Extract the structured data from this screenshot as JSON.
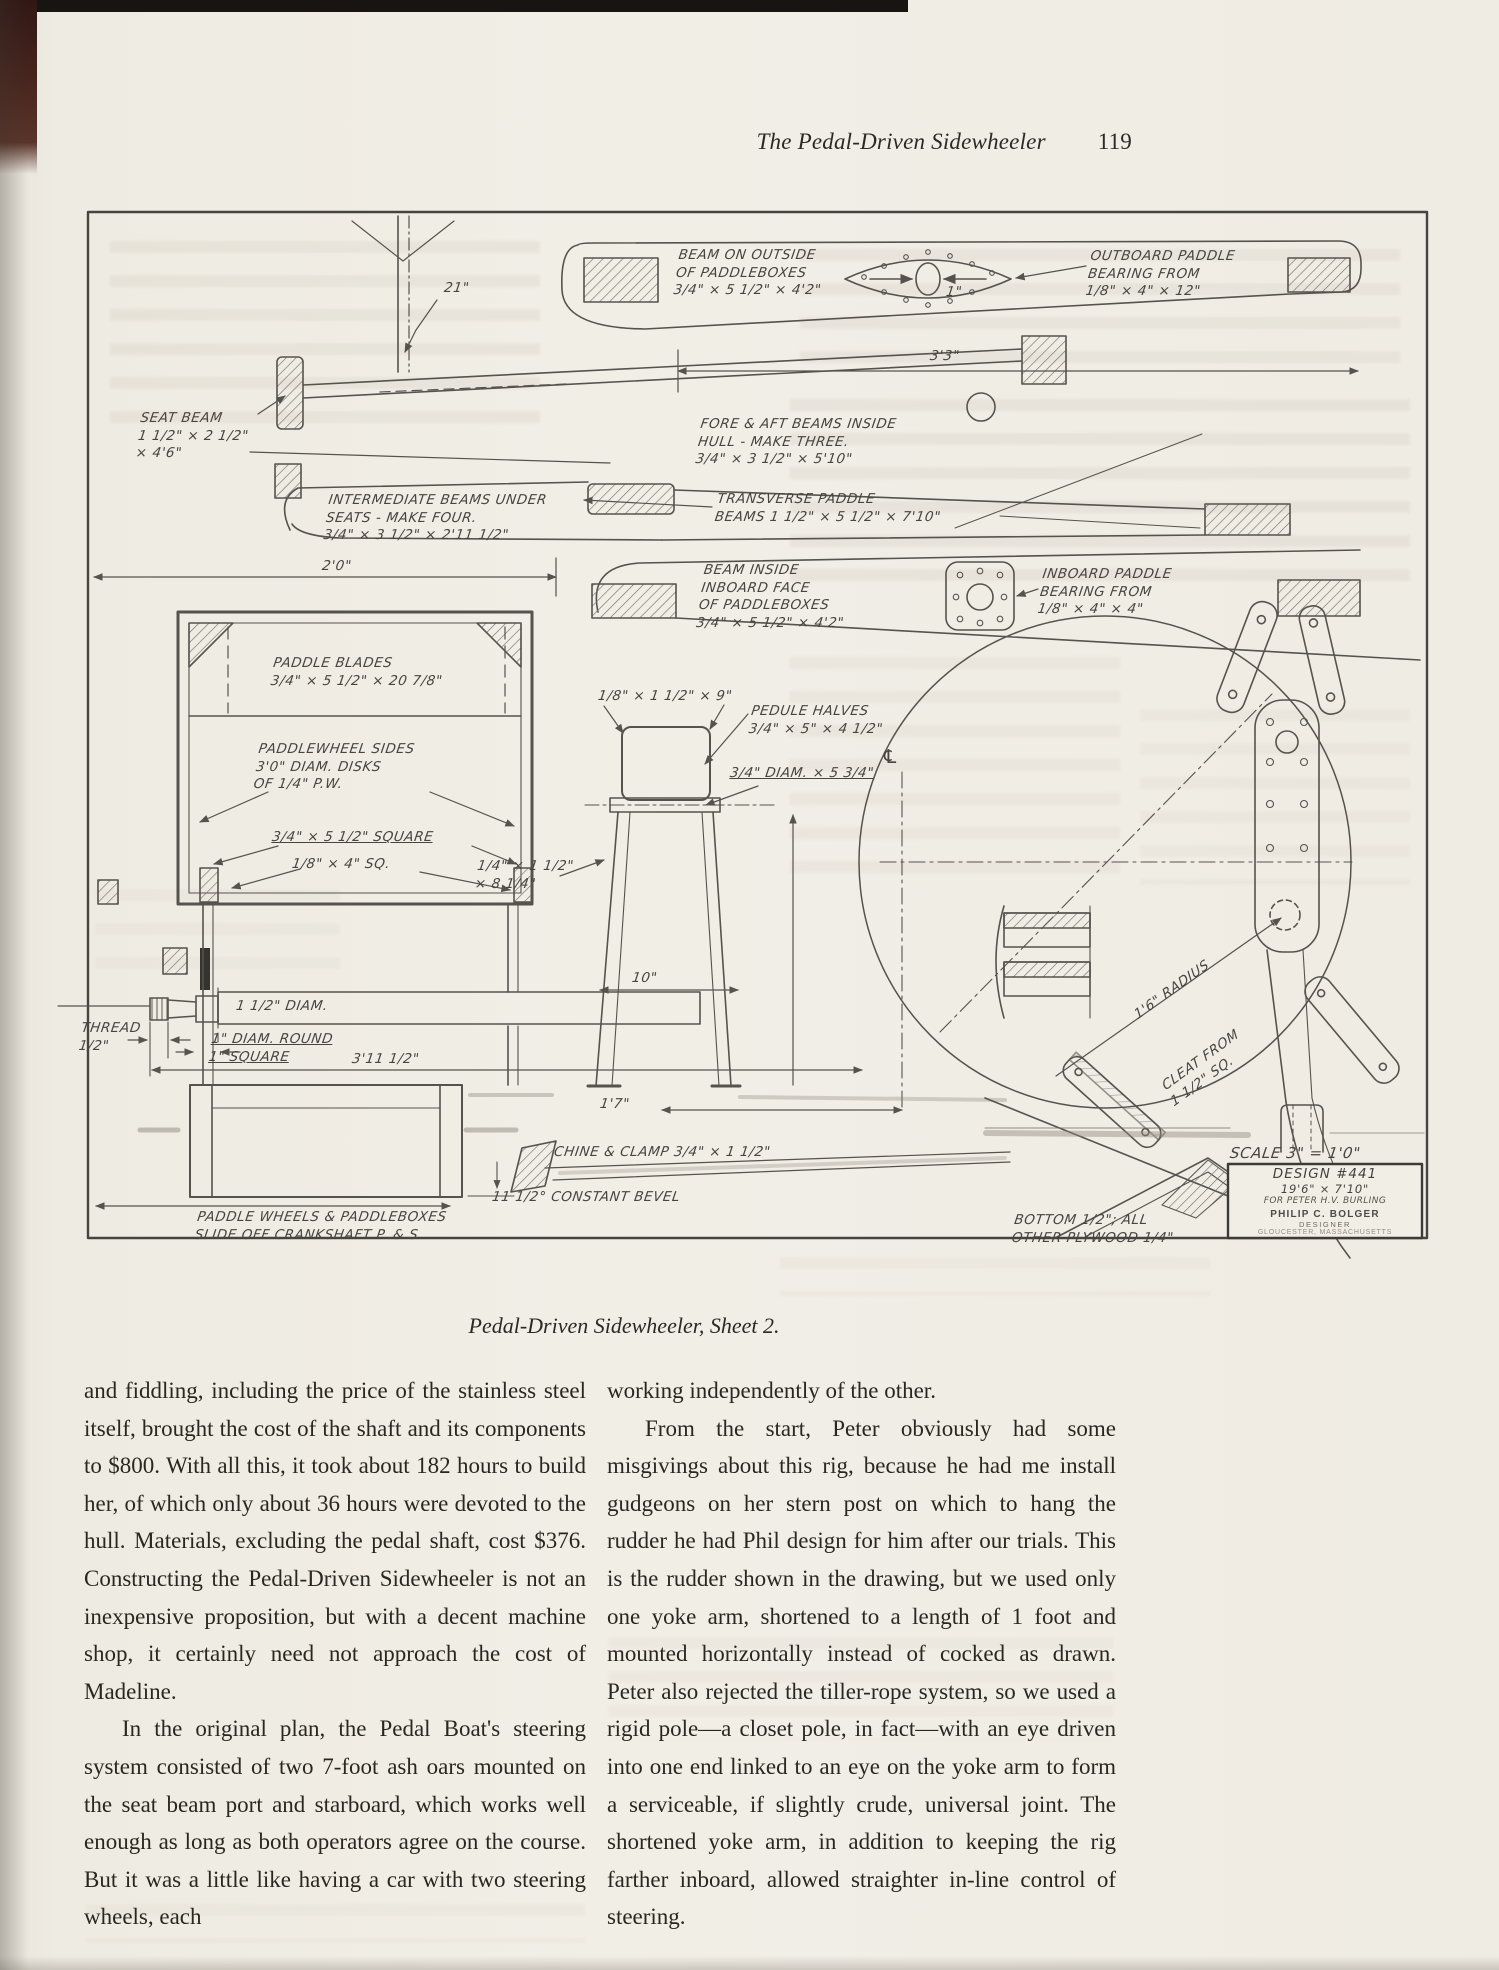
{
  "page": {
    "header": {
      "title": "The Pedal-Driven Sidewheeler",
      "page_number": "119"
    },
    "caption": "Pedal-Driven Sidewheeler, Sheet 2."
  },
  "diagram": {
    "labels": {
      "beam_outside": "BEAM ON OUTSIDE\nOF PADDLEBOXES\n3/4\" × 5 1/2\" × 4'2\"",
      "outboard_bearing": "OUTBOARD PADDLE\nBEARING FROM\n1/8\" × 4\" × 12\"",
      "dim_1in": "1\"",
      "dim_21in": "21\"",
      "dim_3ft3": "3'3\"",
      "seat_beam": "SEAT BEAM\n1 1/2\" × 2 1/2\"\n× 4'6\"",
      "fore_aft": "FORE & AFT BEAMS INSIDE\nHULL - MAKE THREE.\n3/4\" × 3 1/2\" × 5'10\"",
      "intermediate": "INTERMEDIATE BEAMS UNDER\nSEATS - MAKE FOUR.\n3/4\" × 3 1/2\" × 2'11 1/2\"",
      "transverse": "TRANSVERSE PADDLE\nBEAMS 1 1/2\" × 5 1/2\" × 7'10\"",
      "dim_2ft0": "2'0\"",
      "beam_inside": "BEAM INSIDE\nINBOARD FACE\nOF PADDLEBOXES\n3/4\" × 5 1/2\" × 4'2\"",
      "inboard_bearing": "INBOARD PADDLE\nBEARING FROM\n1/8\" × 4\" × 4\"",
      "paddle_blades": "PADDLE BLADES\n3/4\" × 5 1/2\" × 20 7/8\"",
      "paddlewheel_sides": "PADDLEWHEEL SIDES\n3'0\" DIAM. DISKS\nOF 1/4\" P.W.",
      "square_34": "3/4\" × 5 1/2\" SQUARE",
      "sq_18": "1/8\" × 4\" SQ.",
      "pedal_strap": "1/8\" × 1 1/2\" × 9\"",
      "pedal_halves": "PEDULE HALVES\n3/4\" × 5\" × 4 1/2\"",
      "pedal_axle": "3/4\" DIAM. × 5 3/4\"",
      "strap_2": "1/4\" × 1 1/2\"\n× 8 1/4\"",
      "diam_112": "1 1/2\" DIAM.",
      "thread": "THREAD\n1/2\"",
      "round_sq": "1\" DIAM. ROUND\n1\" SQUARE",
      "dim_3ft11": "3'11 1/2\"",
      "dim_10": "10\"",
      "dim_1ft7": "1'7\"",
      "centerline": "℄",
      "chine": "CHINE & CLAMP 3/4\" × 1 1/2\"",
      "bevel": "11 1/2° CONSTANT BEVEL",
      "paddlewheels_slide": "PADDLE WHEELS & PADDLEBOXES\nSLIDE OFF CRANKSHAFT P. & S.",
      "radius": "1'6\" RADIUS",
      "cleat": "CLEAT FROM\n1 1/2\" SQ.",
      "scale": "SCALE 3\" = 1'0\"",
      "bottom_ply": "BOTTOM 1/2\"; ALL\nOTHER PLYWOOD 1/4\""
    },
    "design_block": {
      "line1": "DESIGN #441",
      "line2": "19'6\" × 7'10\"",
      "line3": "FOR PETER H.V. BURLING",
      "designer_name": "PHILIP C. BOLGER",
      "designer_title": "DESIGNER",
      "designer_city": "GLOUCESTER, MASSACHUSETTS"
    }
  },
  "article": {
    "left_column": {
      "p1": "and fiddling, including the price of the stainless steel itself, brought the cost of the shaft and its components to $800. With all this, it took about 182 hours to build her, of which only about 36 hours were devoted to the hull. Materials, excluding the pedal shaft, cost $376. Constructing the Pedal-Driven Sidewheeler is not an inexpensive proposition, but with a decent machine shop, it certainly need not approach the cost of Madeline.",
      "p2": "In the original plan, the Pedal Boat's steering system consisted of two 7-foot ash oars mounted on the seat beam port and starboard, which works well enough as long as both operators agree on the course. But it was a little like having a car with two steering wheels, each"
    },
    "right_column": {
      "p1": "working independently of the other.",
      "p2": "From the start, Peter obviously had some misgivings about this rig, because he had me install gudgeons on her stern post on which to hang the rudder he had Phil design for him after our trials. This is the rudder shown in the drawing, but we used only one yoke arm, shortened to a length of 1 foot and mounted horizontally instead of cocked as drawn. Peter also rejected the tiller-rope system, so we used a rigid pole—a closet pole, in fact—with an eye driven into one end linked to an eye on the yoke arm to form a serviceable, if slightly crude, universal joint. The shortened yoke arm, in addition to keeping the rig farther inboard, allowed straighter in-line control of steering."
    }
  }
}
